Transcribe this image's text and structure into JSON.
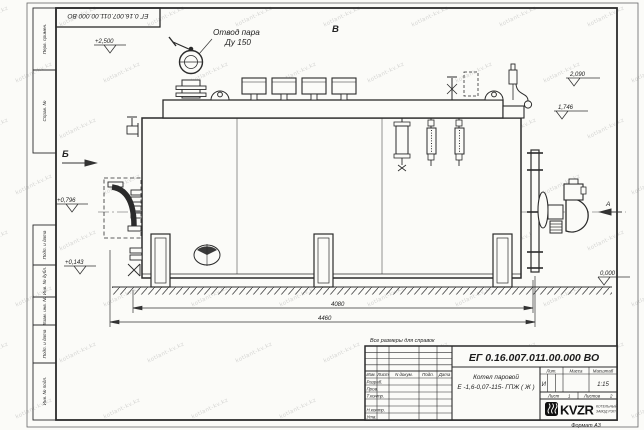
{
  "watermark": {
    "text": "kotlant-kv.kz"
  },
  "margin_labels": {
    "perv": "Перв. примен.",
    "sprav": "Справ. №",
    "podp1": "Подп. и дата",
    "inv_dubl": "Инв. № дубл.",
    "vzam": "Взам. инв. №",
    "podp2": "Подп. и дата",
    "inv_podl": "Инв. № подл."
  },
  "corner_stamp": {
    "doc_number": "ЕГ 0.16.007.011.00.000  ВО"
  },
  "drawing": {
    "callout_steam_line1": "Отвод пара",
    "callout_steam_line2": "Ду 150",
    "view_b": "Б",
    "view_v": "В",
    "view_a": "А",
    "elev_2500": "+2,500",
    "elev_2090": "2,090",
    "elev_1746": "1,746",
    "elev_0796": "+0,796",
    "elev_0143": "+0,143",
    "elev_0000": "0,000",
    "dim_4080": "4080",
    "dim_4460": "4460",
    "note": "Все размеры для справок"
  },
  "title_block": {
    "doc_number": "ЕГ 0.16.007.011.00.000  ВО",
    "product_line1": "Котел паровой",
    "product_line2": "Е -1,6-0,07-115- ГПЖ ( Ж )",
    "col_izm": "Изм.",
    "col_list": "Лист",
    "col_ndokum": "N докум.",
    "col_podp": "Подп.",
    "col_data": "Дата",
    "row_razrab": "Разраб.",
    "row_prov": "Пров.",
    "row_tkontr": "Т.контр.",
    "row_nkontr": "Н.контр.",
    "row_utv": "Утв.",
    "lit_label": "Лит.",
    "massa_label": "Масса",
    "masshtab_label": "Масштаб",
    "lit_value": "И",
    "scale_value": "1:15",
    "sheet_label": "Лист",
    "sheet_value": "1",
    "sheets_label": "Листов",
    "sheets_value": "2",
    "logo": "KVZR",
    "company_line1": "КОТЕЛЬНЫЙ",
    "company_line2": "ЗАВОД РЭП",
    "format_label": "Формат А3"
  }
}
